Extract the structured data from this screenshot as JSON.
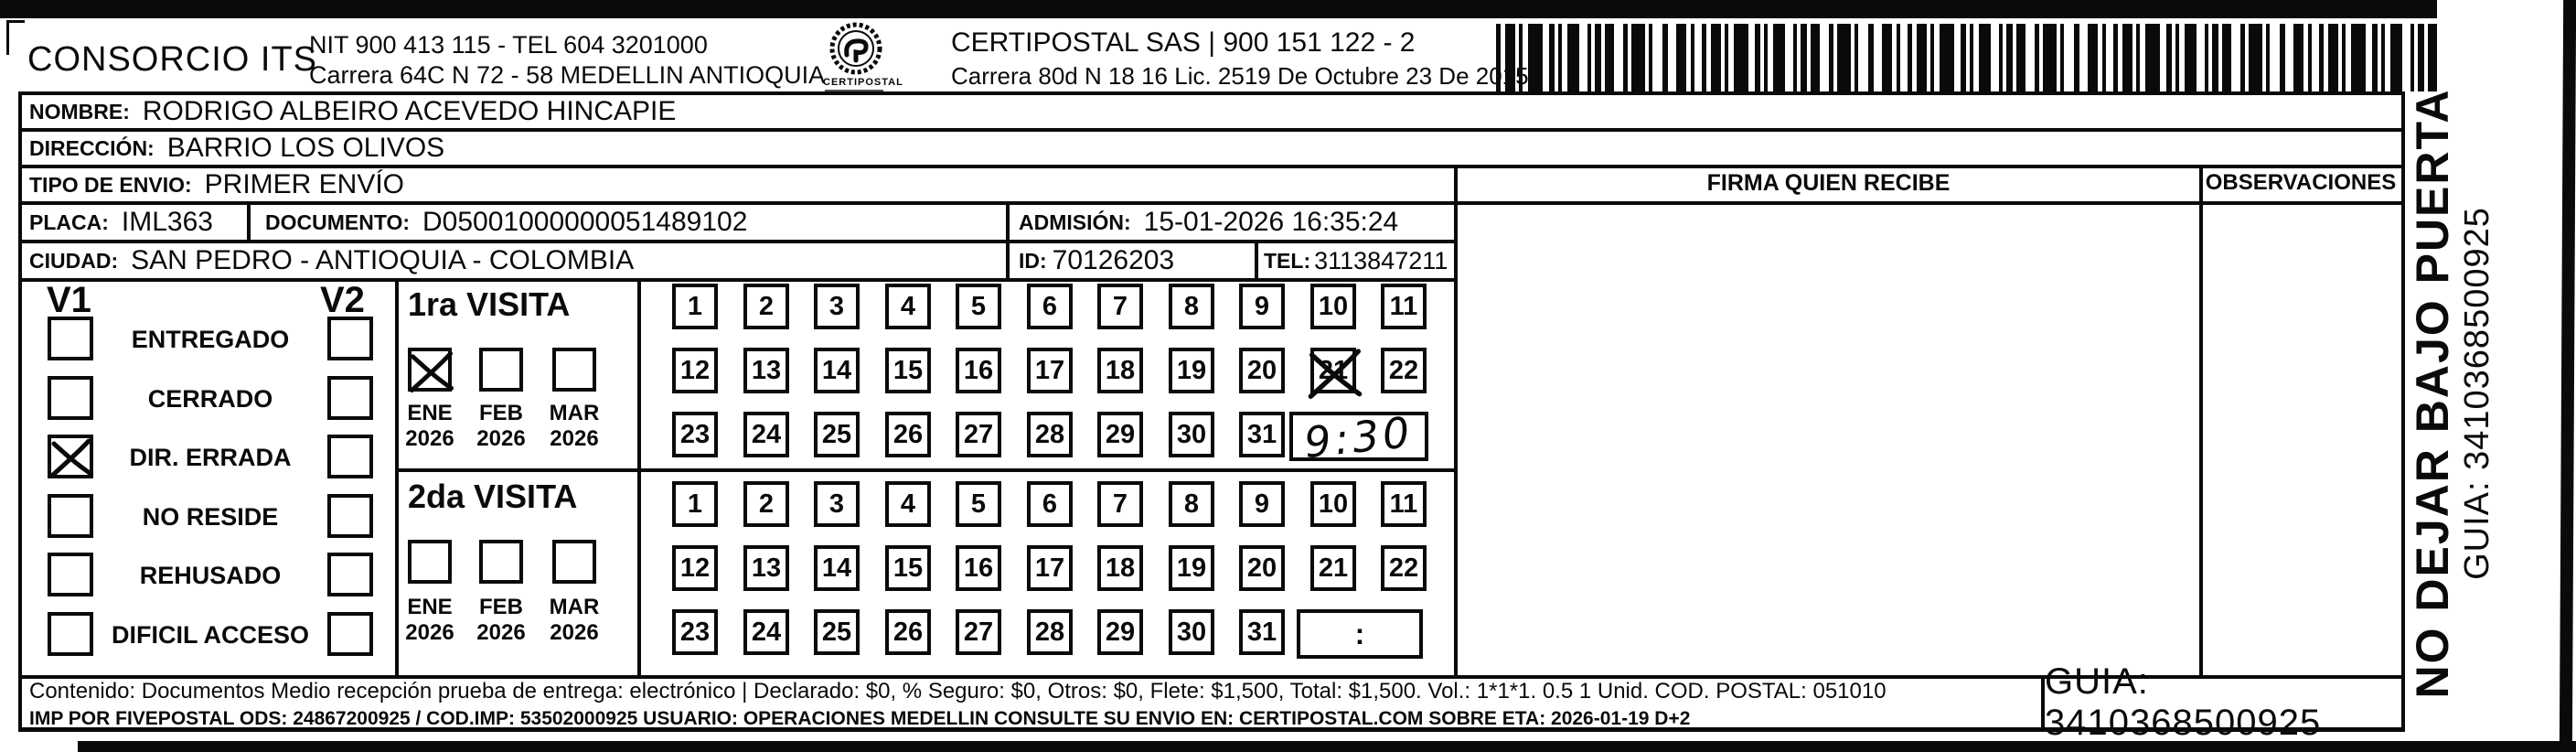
{
  "header": {
    "company": "CONSORCIO ITS",
    "nit_line": "NIT 900 413 115 - TEL 604 3201000",
    "company_address": "Carrera 64C N 72 - 58 MEDELLIN ANTIOQUIA",
    "logo_caption": "CERTIPOSTAL",
    "carrier_line": "CERTIPOSTAL SAS | 900 151 122 - 2",
    "carrier_address": "Carrera 80d N 18 16  Lic. 2519 De Octubre 23 De 2015"
  },
  "shipment": {
    "nombre_label": "NOMBRE:",
    "nombre": "RODRIGO ALBEIRO ACEVEDO HINCAPIE",
    "direccion_label": "DIRECCIÓN:",
    "direccion": "BARRIO LOS OLIVOS",
    "tipo_envio_label": "TIPO DE ENVIO:",
    "tipo_envio": "PRIMER ENVÍO",
    "placa_label": "PLACA:",
    "placa": "IML363",
    "documento_label": "DOCUMENTO:",
    "documento": "D05001000000051489102",
    "admision_label": "ADMISIÓN:",
    "admision": "15-01-2026 16:35:24",
    "ciudad_label": "CIUDAD:",
    "ciudad": "SAN PEDRO - ANTIOQUIA - COLOMBIA",
    "id_label": "ID:",
    "id": "70126203",
    "tel_label": "TEL:",
    "tel": "3113847211"
  },
  "signature": {
    "firma_header": "FIRMA QUIEN RECIBE",
    "observaciones_header": "OBSERVACIONES"
  },
  "status_panel": {
    "v1_header": "V1",
    "v2_header": "V2",
    "options": [
      {
        "label": "ENTREGADO",
        "v1": false,
        "v2": false
      },
      {
        "label": "CERRADO",
        "v1": false,
        "v2": false
      },
      {
        "label": "DIR. ERRADA",
        "v1": true,
        "v2": false
      },
      {
        "label": "NO RESIDE",
        "v1": false,
        "v2": false
      },
      {
        "label": "REHUSADO",
        "v1": false,
        "v2": false
      },
      {
        "label": "DIFICIL ACCESO",
        "v1": false,
        "v2": false
      }
    ]
  },
  "visits": {
    "day_numbers": [
      1,
      2,
      3,
      4,
      5,
      6,
      7,
      8,
      9,
      10,
      11,
      12,
      13,
      14,
      15,
      16,
      17,
      18,
      19,
      20,
      21,
      22,
      23,
      24,
      25,
      26,
      27,
      28,
      29,
      30,
      31
    ],
    "first": {
      "title": "1ra VISITA",
      "months": [
        {
          "month": "ENE",
          "year": "2026",
          "checked": true
        },
        {
          "month": "FEB",
          "year": "2026",
          "checked": false
        },
        {
          "month": "MAR",
          "year": "2026",
          "checked": false
        }
      ],
      "crossed_day": 21,
      "time": "9:30",
      "time_handwritten": true
    },
    "second": {
      "title": "2da VISITA",
      "months": [
        {
          "month": "ENE",
          "year": "2026",
          "checked": false
        },
        {
          "month": "FEB",
          "year": "2026",
          "checked": false
        },
        {
          "month": "MAR",
          "year": "2026",
          "checked": false
        }
      ],
      "crossed_day": null,
      "time": ":",
      "time_handwritten": false
    }
  },
  "footer": {
    "line1": "Contenido: Documentos Medio recepción prueba de entrega: electrónico | Declarado: $0, % Seguro: $0, Otros: $0, Flete: $1,500, Total: $1,500. Vol.: 1*1*1. 0.5  1 Unid. COD. POSTAL: 051010",
    "line2": "IMP POR FIVEPOSTAL ODS: 24867200925 / COD.IMP: 53502000925 USUARIO: OPERACIONES MEDELLIN CONSULTE SU ENVIO EN: CERTIPOSTAL.COM SOBRE ETA: 2026-01-19 D+2",
    "guia": "GUIA: 3410368500925"
  },
  "side_note": {
    "line1": "NO DEJAR BAJO PUERTA",
    "line2": "GUIA: 3410368500925"
  },
  "colors": {
    "ink": "#0a0a0a",
    "paper": "#ffffff"
  }
}
